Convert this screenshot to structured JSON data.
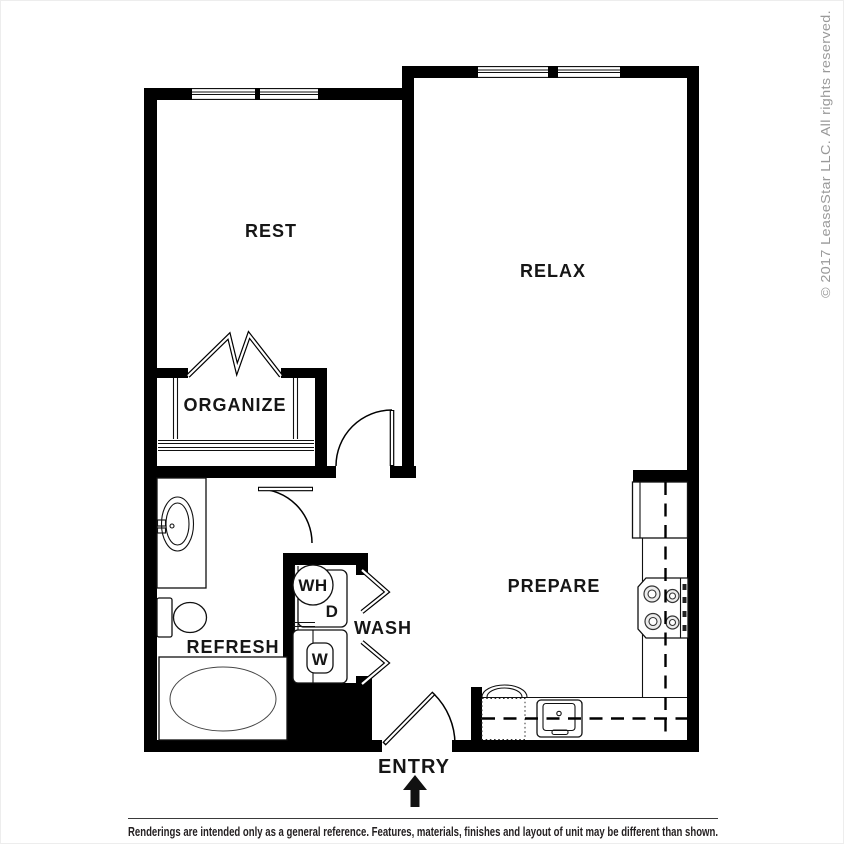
{
  "floorplan": {
    "rooms": {
      "rest": "REST",
      "relax": "RELAX",
      "organize": "ORGANIZE",
      "refresh": "REFRESH",
      "wash": "WASH",
      "prepare": "PREPARE"
    },
    "appliances": {
      "water_heater": "WH",
      "dryer": "D",
      "washer": "W"
    },
    "entry_label": "ENTRY"
  },
  "copyright": {
    "text": "© 2017 LeaseStar LLC. All rights reserved."
  },
  "footer": {
    "disclaimer": "Renderings are intended only as a general reference. Features, materials, finishes and layout of unit may be different than shown."
  },
  "colors": {
    "wall": "#000000",
    "background": "#ffffff",
    "label_text": "#161616",
    "copyright_text": "#999999",
    "disclaimer_text": "#231f20"
  }
}
